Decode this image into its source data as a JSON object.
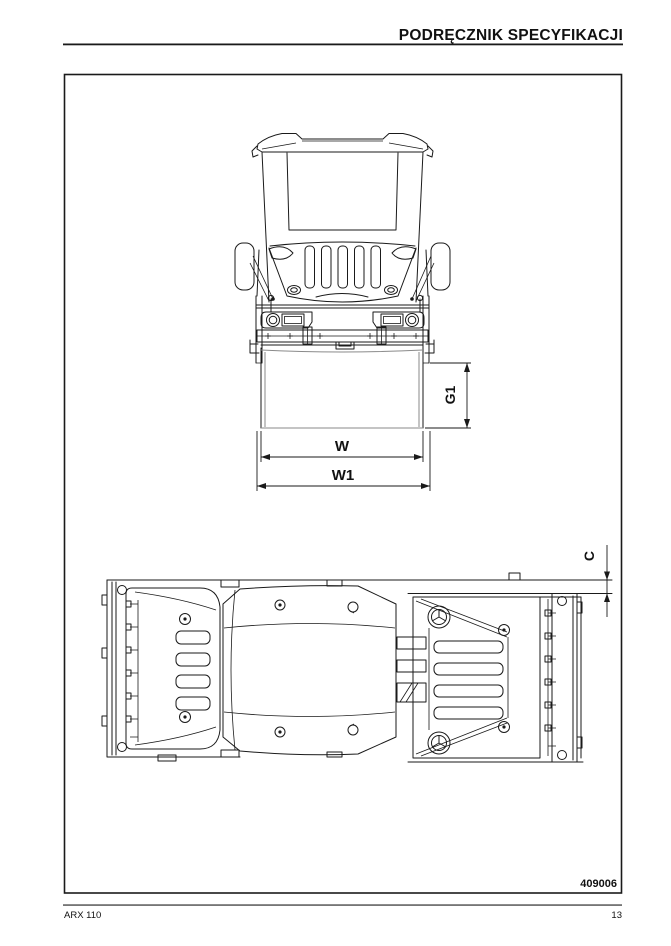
{
  "page": {
    "header": {
      "title": "PODRĘCZNIK SPECYFIKACJI"
    },
    "footer": {
      "model": "ARX 110",
      "page_number": "13"
    }
  },
  "figure": {
    "number": "409006",
    "description": "Dimension drawing of ARX 110 tandem roller: front view and top (plan) view",
    "views": {
      "front": {
        "dimension_labels": {
          "g1": "G1",
          "w": "W",
          "w1": "W1"
        }
      },
      "top": {
        "dimension_labels": {
          "c": "C"
        }
      }
    }
  },
  "colors": {
    "line": "#1a1a1a",
    "gray_line": "#8a8a8a",
    "text": "#111111",
    "background": "#ffffff"
  }
}
